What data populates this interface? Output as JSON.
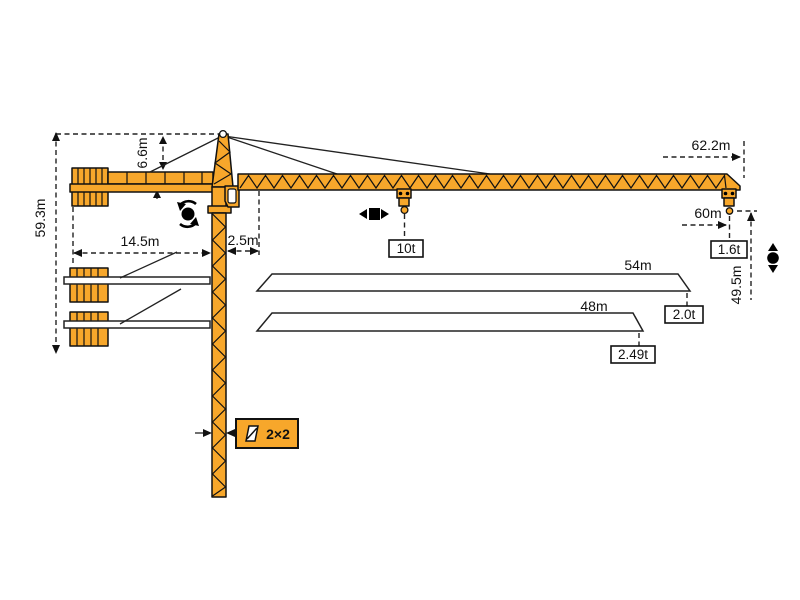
{
  "diagram": {
    "type": "tower-crane-specification-drawing",
    "colors": {
      "crane": "#F7A72B",
      "outline": "#111111",
      "background": "#FFFFFF"
    },
    "heights": {
      "overall": "59.3m",
      "tower_head": "6.6m",
      "hook_at_tip": "49.5m"
    },
    "radii": {
      "counter_jib": "14.5m",
      "jib_root_offset": "2.5m",
      "max_radius": "62.2m",
      "near_tip_radius": "60m"
    },
    "capacities": {
      "max_load": "10t",
      "tip_load_max_radius": "1.6t",
      "jib_variants": [
        {
          "length": "54m",
          "tip_load": "2.0t"
        },
        {
          "length": "48m",
          "tip_load": "2.49t"
        }
      ]
    },
    "mast": {
      "section_label": "2×2"
    },
    "symbols": [
      "slewing-icon",
      "trolley-travel-icon",
      "hoist-icon",
      "mast-section-icon"
    ]
  }
}
